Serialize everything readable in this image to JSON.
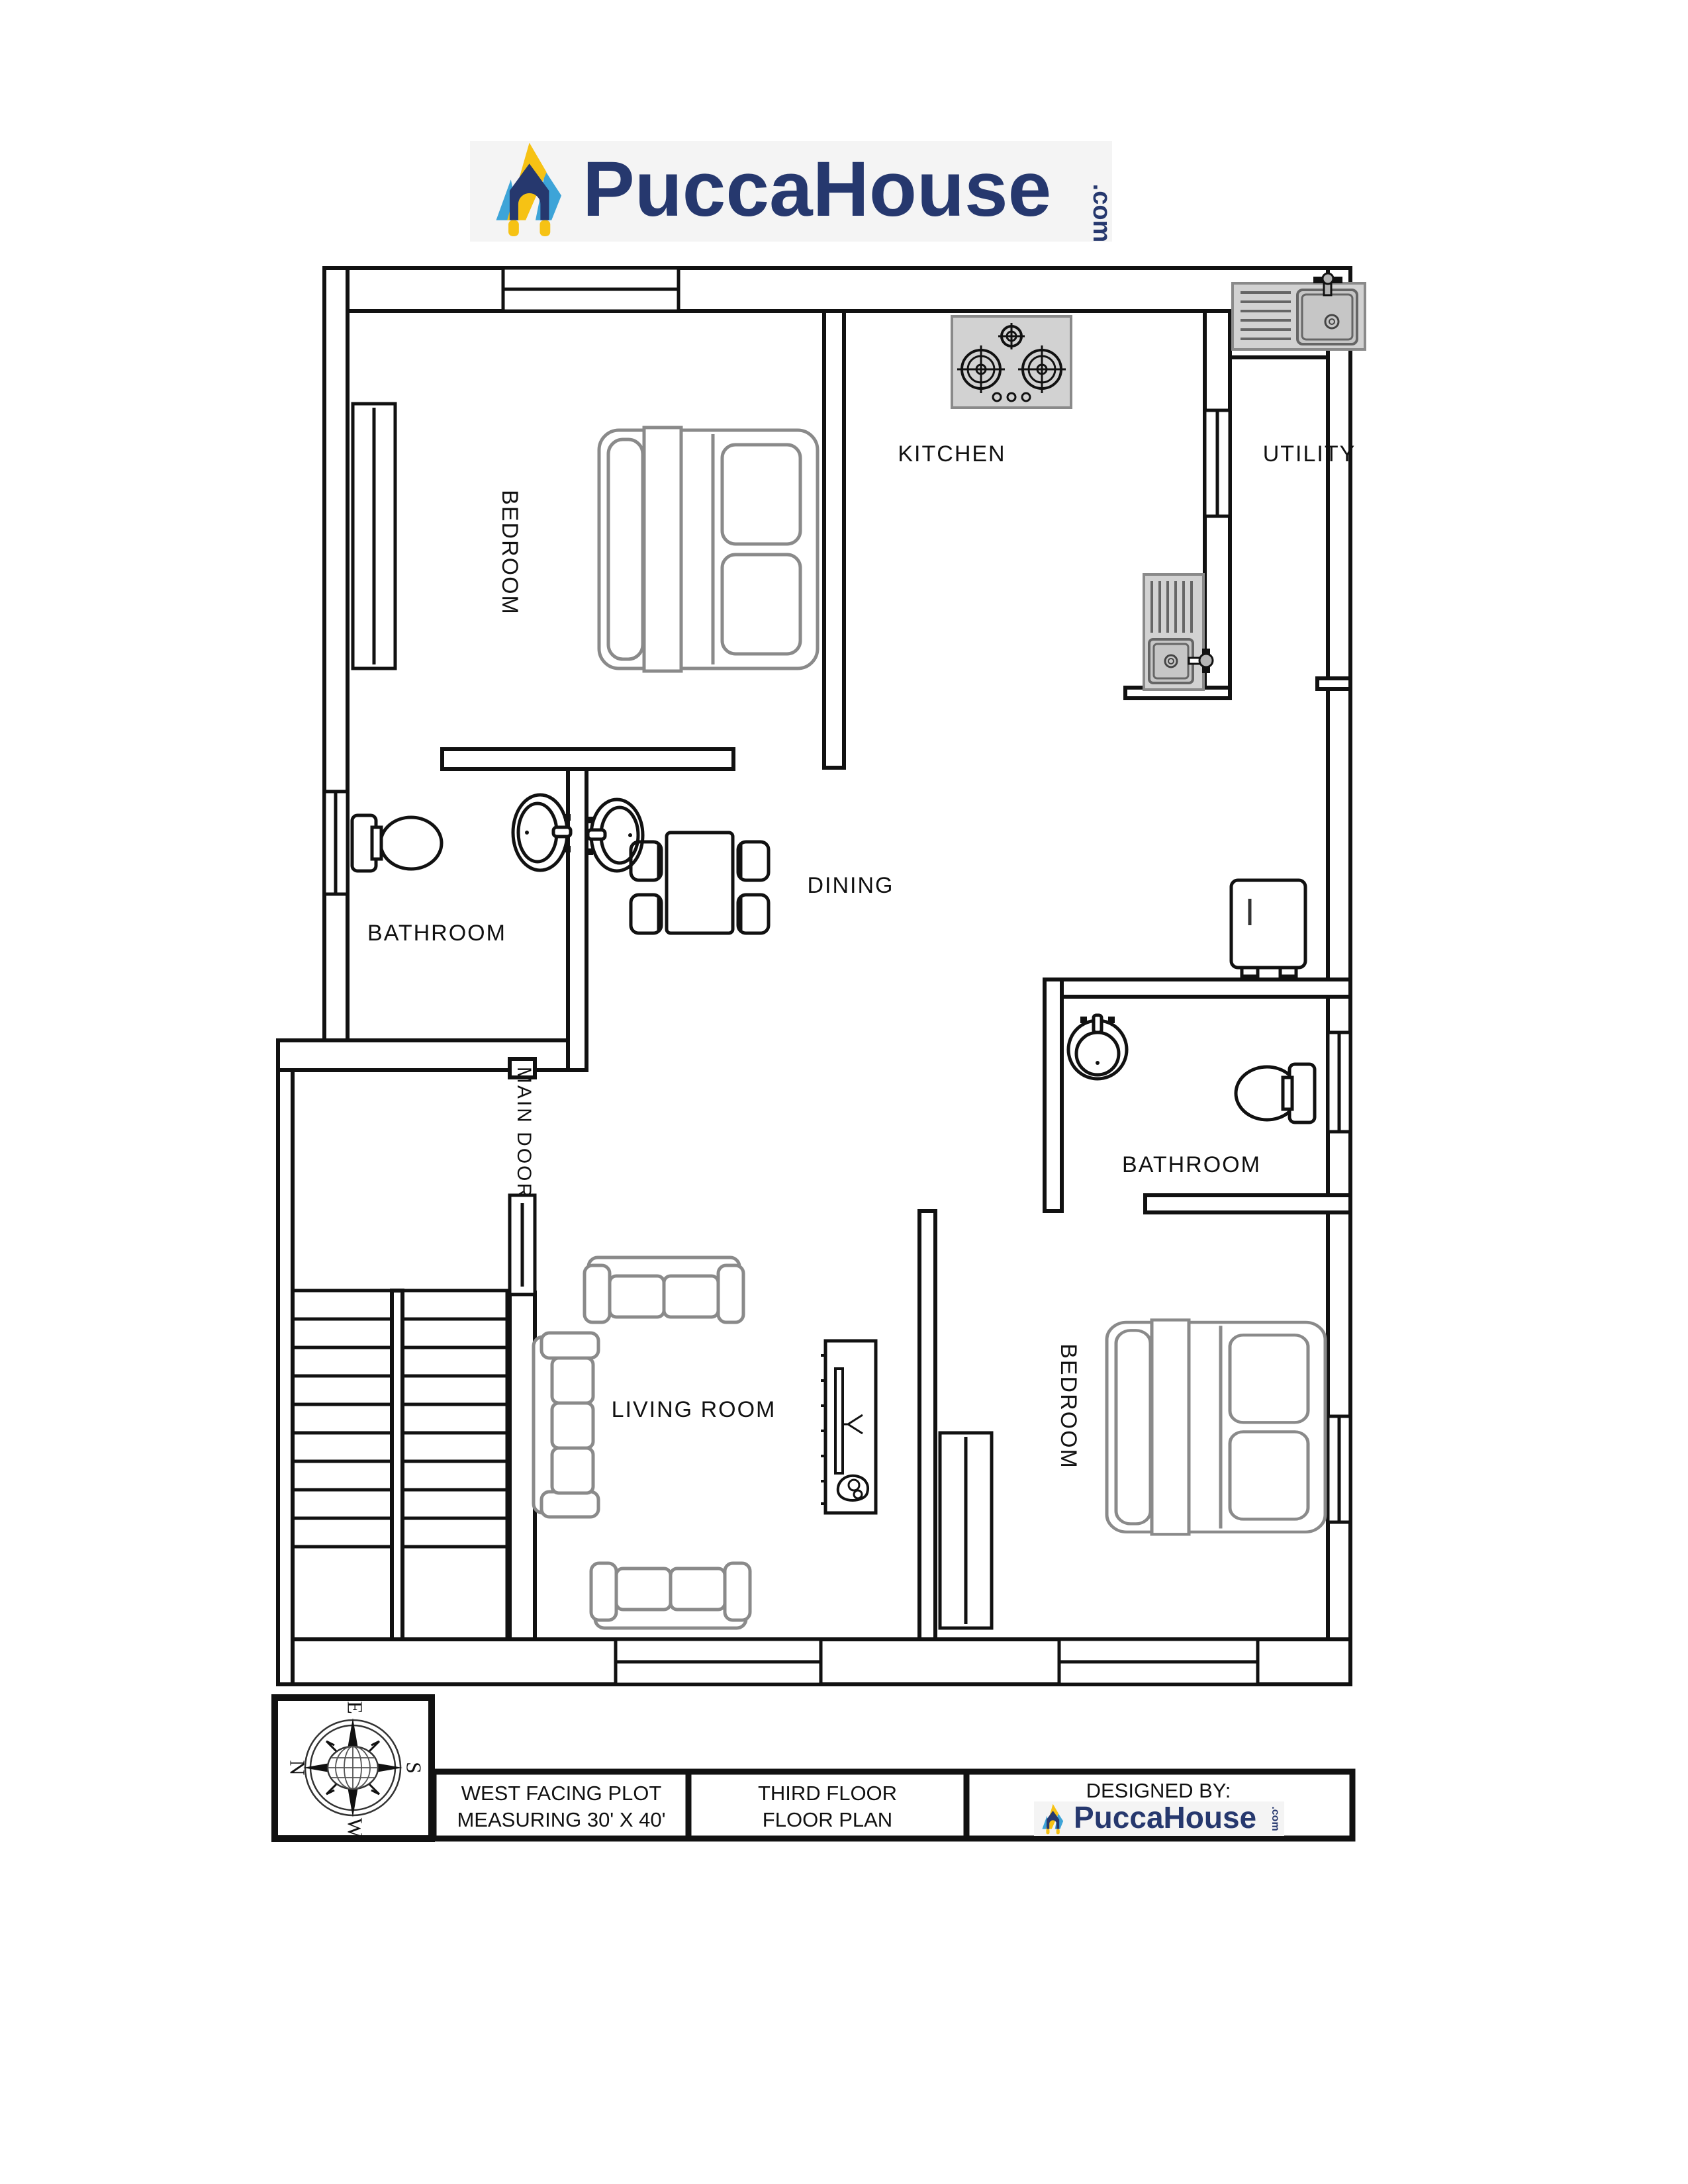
{
  "header": {
    "brand": "PuccaHouse",
    "brand_suffix": ".com"
  },
  "plan": {
    "rooms": [
      {
        "id": "bedroom-1",
        "label": "BEDROOM"
      },
      {
        "id": "kitchen",
        "label": "KITCHEN"
      },
      {
        "id": "utility",
        "label": "UTILITY"
      },
      {
        "id": "bathroom-1",
        "label": "BATHROOM"
      },
      {
        "id": "dining",
        "label": "DINING"
      },
      {
        "id": "bathroom-2",
        "label": "BATHROOM"
      },
      {
        "id": "living-room",
        "label": "LIVING ROOM"
      },
      {
        "id": "bedroom-2",
        "label": "BEDROOM"
      }
    ],
    "main_door_label": "MAIN DOOR",
    "fixture_icons": [
      "wardrobe-icon",
      "double-bed-icon",
      "gas-stove-icon",
      "kitchen-sink-icon",
      "utility-sink-icon",
      "wash-basin-icon",
      "toilet-icon",
      "refrigerator-icon",
      "dining-table-icon",
      "sofa-icon",
      "tv-unit-icon",
      "staircase-icon",
      "compass-rose-icon",
      "house-logo-icon"
    ]
  },
  "compass": {
    "top": "E",
    "right": "S",
    "bottom": "W",
    "left": "N"
  },
  "title_block": {
    "cell1_line1": "WEST FACING PLOT",
    "cell1_line2": "MEASURING 30' X 40'",
    "cell2_line1": "THIRD FLOOR",
    "cell2_line2": "FLOOR PLAN",
    "cell3_line1": "DESIGNED BY:",
    "brand": "PuccaHouse",
    "brand_suffix": ".com"
  },
  "colors": {
    "wall": "#111111",
    "furniture_stroke": "#8a8a8a",
    "fixture_fill": "#d2d2d2",
    "brand_navy": "#26386e",
    "brand_yellow": "#f6c214",
    "brand_blue": "#3da4d8",
    "logo_background": "#f4f4f4"
  }
}
